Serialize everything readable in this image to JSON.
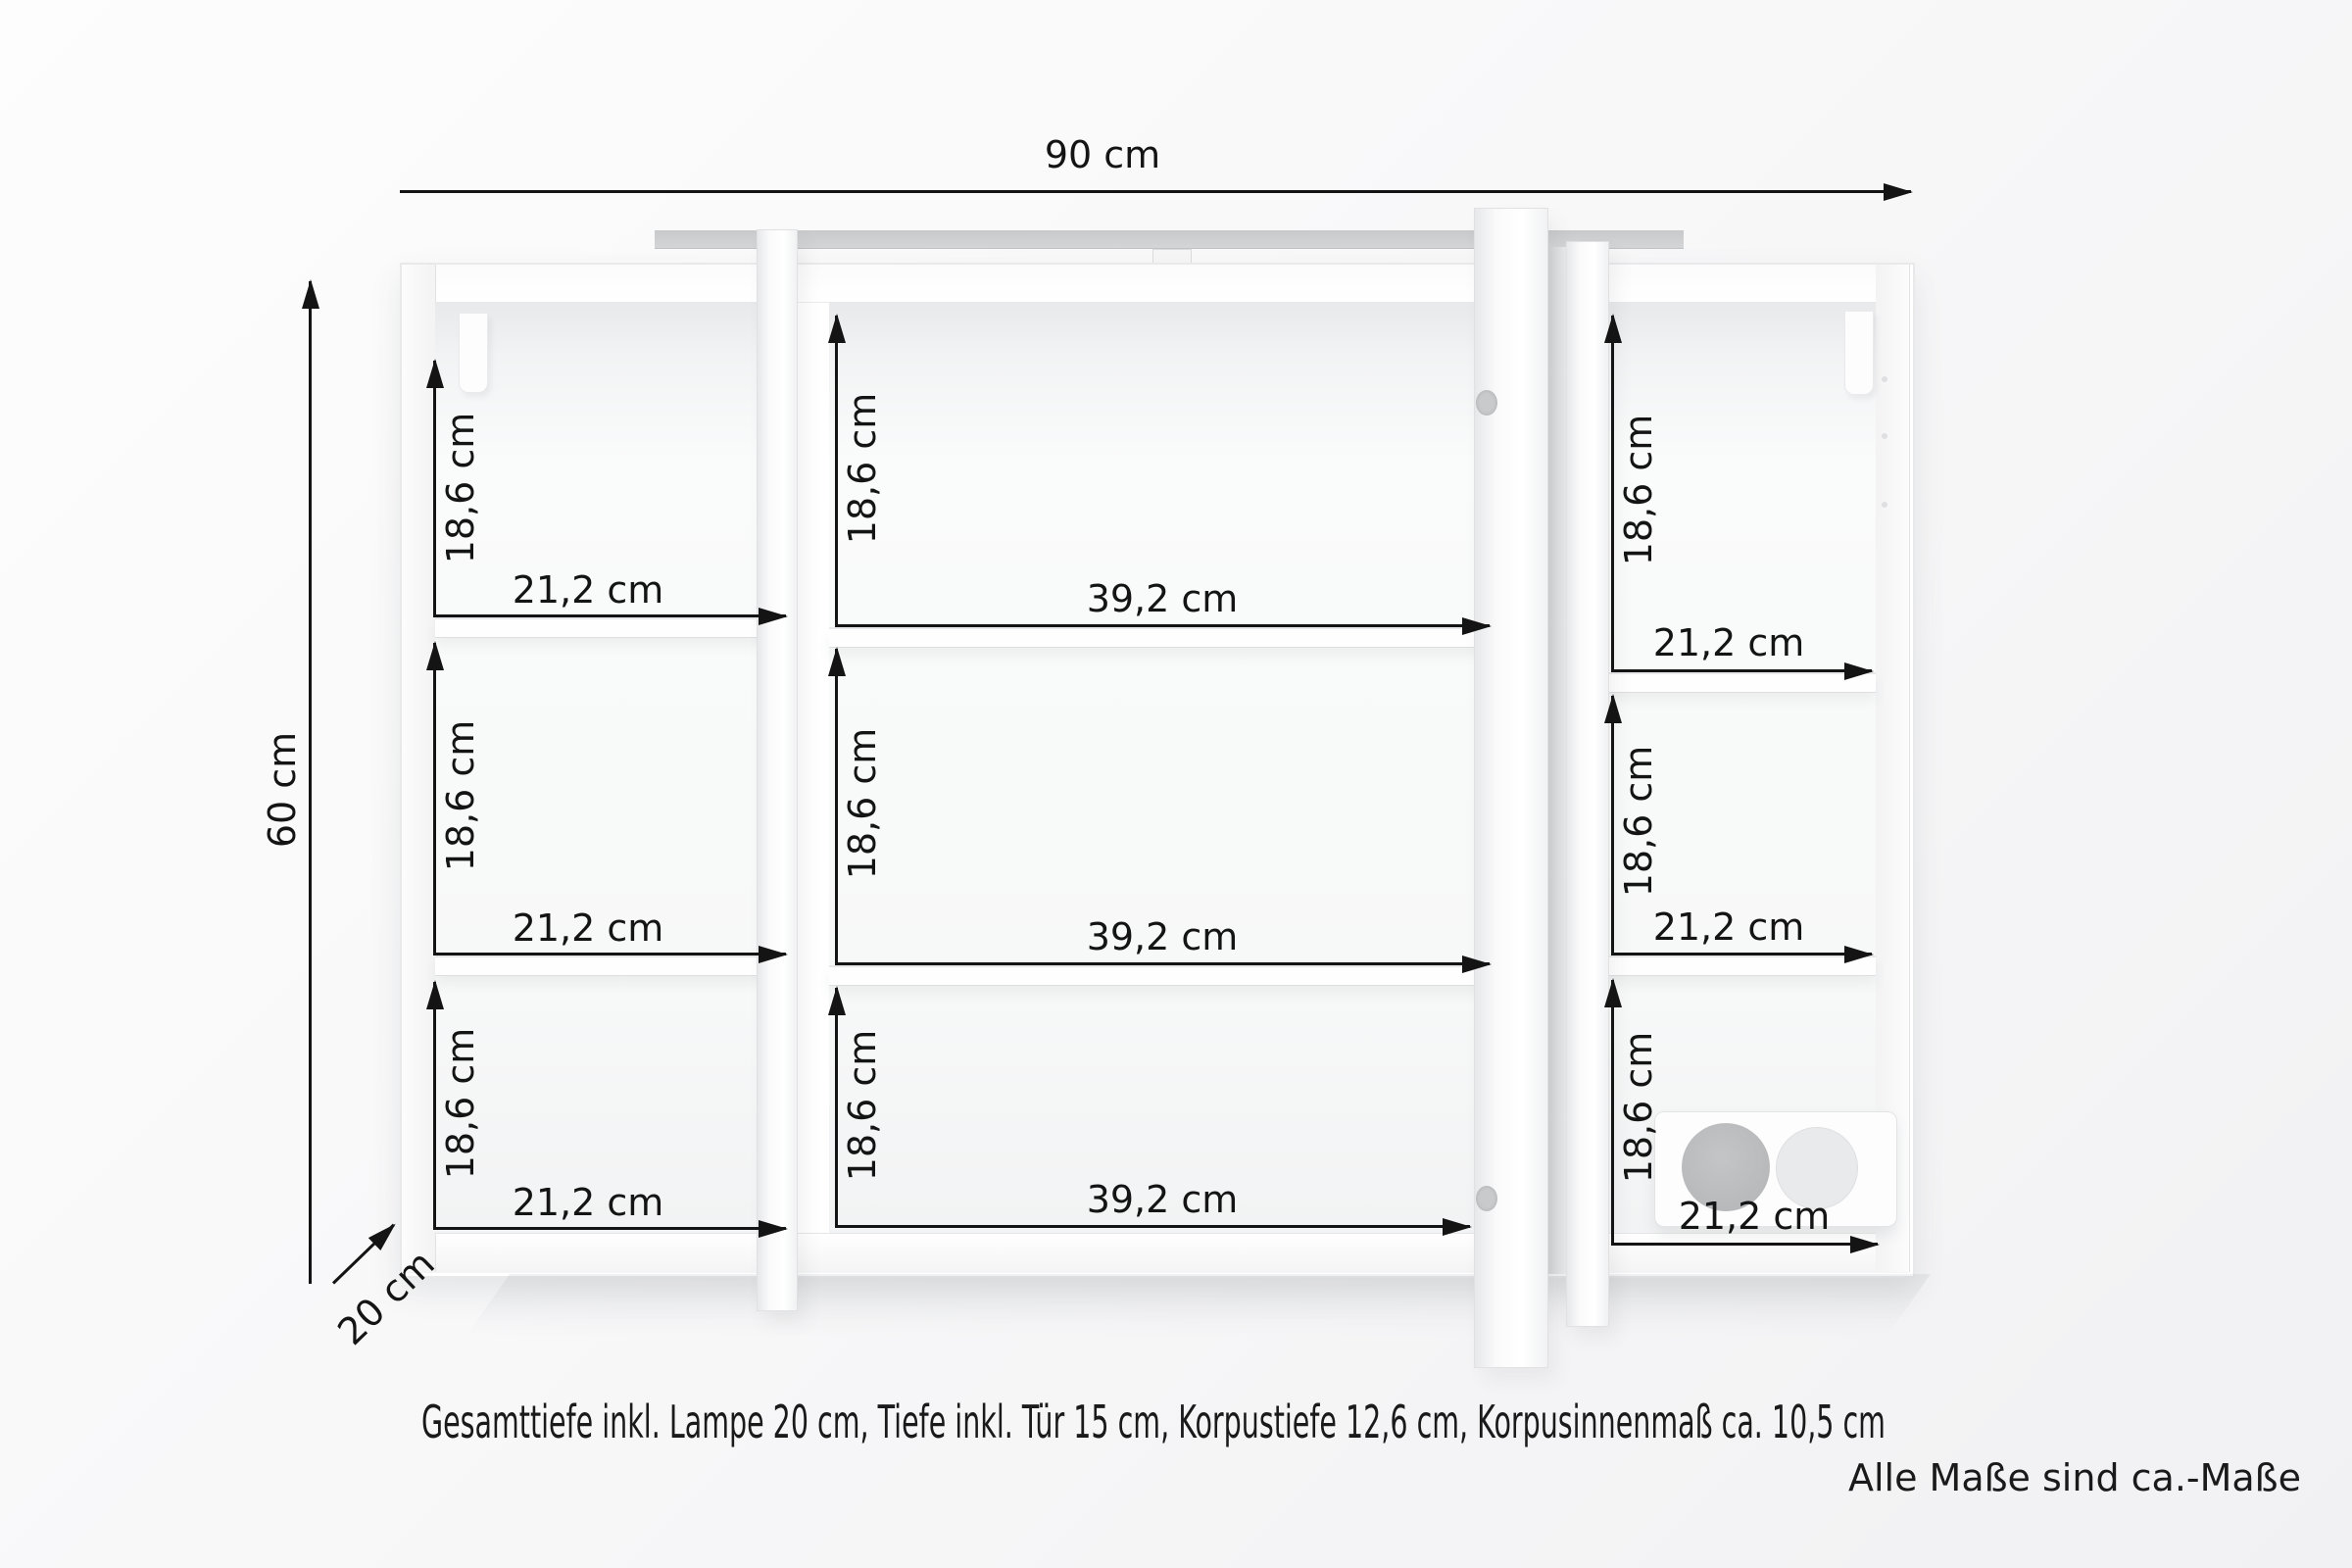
{
  "diagram": {
    "type": "furniture-dimension-diagram",
    "overall": {
      "width_label": "90 cm",
      "height_label": "60 cm",
      "depth_label": "20 cm"
    },
    "sections": [
      {
        "name": "left",
        "compartments": [
          {
            "height_label": "18,6 cm",
            "width_label": "21,2 cm"
          },
          {
            "height_label": "18,6 cm",
            "width_label": "21,2 cm"
          },
          {
            "height_label": "18,6 cm",
            "width_label": "21,2 cm"
          }
        ]
      },
      {
        "name": "middle",
        "compartments": [
          {
            "height_label": "18,6 cm",
            "width_label": "39,2 cm"
          },
          {
            "height_label": "18,6 cm",
            "width_label": "39,2 cm"
          },
          {
            "height_label": "18,6 cm",
            "width_label": "39,2 cm"
          }
        ]
      },
      {
        "name": "right",
        "compartments": [
          {
            "height_label": "18,6 cm",
            "width_label": "21,2 cm"
          },
          {
            "height_label": "18,6 cm",
            "width_label": "21,2 cm"
          },
          {
            "height_label": "18,6 cm",
            "width_label": "21,2 cm"
          }
        ]
      }
    ],
    "notes": {
      "depth_note": "Gesamttiefe inkl. Lampe 20 cm, Tiefe inkl. Tür 15 cm, Korpustiefe 12,6 cm, Korpusinnenmaß ca. 10,5 cm",
      "disclaimer": "Alle Maße sind ca.-Maße"
    },
    "colors": {
      "dimension_line": "#141414",
      "text": "#1a1a1a",
      "light_panel": "#c9cbcd",
      "cabinet": "#ffffff",
      "background": "#f6f6f7"
    }
  }
}
